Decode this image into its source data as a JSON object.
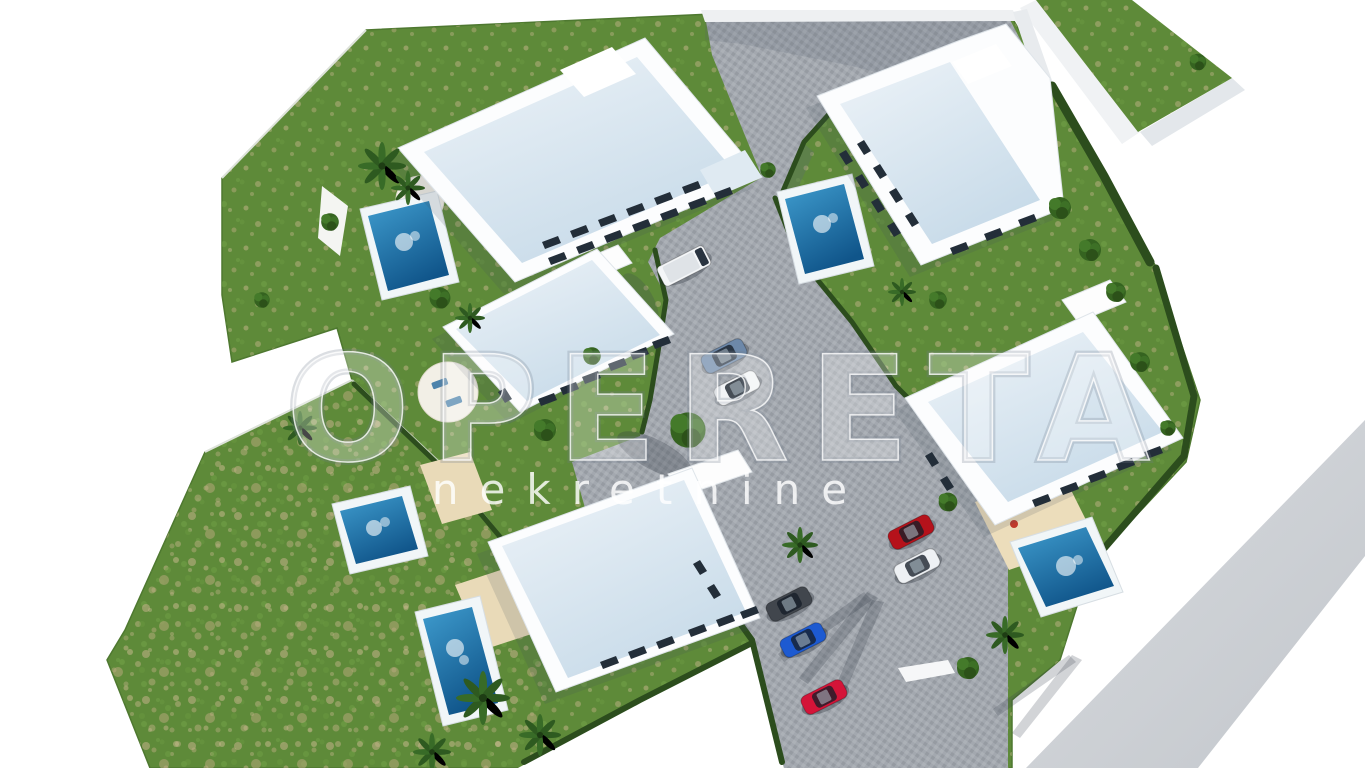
{
  "watermark": {
    "title": "OPERETA",
    "subtitle": "nekretnine"
  },
  "palette": {
    "background": "#ffffff",
    "grass": "#5e8a39",
    "hedge": "#2c4d1d",
    "pool_rim": "#f1f6f8",
    "pool_water": "#1e77ad",
    "pavement": "#a3a8af",
    "ribbon_road": "#cdd1d5",
    "building": "#fcfdfe",
    "roof": "#d8e5f0",
    "deck": "#e9dab8",
    "wall": "#eef0f2"
  },
  "vehicles": [
    {
      "name": "white-van",
      "color": "#f4f6f8"
    },
    {
      "name": "slate-blue-sedan",
      "color": "#6d88a9"
    },
    {
      "name": "white-sedan",
      "color": "#f2f4f6"
    },
    {
      "name": "red-coupe",
      "color": "#b5121b"
    },
    {
      "name": "white-hatchback",
      "color": "#eef1f4"
    },
    {
      "name": "graphite-car",
      "color": "#41464d"
    },
    {
      "name": "blue-hatchback",
      "color": "#1d5ad1"
    },
    {
      "name": "crimson-car",
      "color": "#d41438"
    }
  ],
  "site": {
    "buildings": 5,
    "pools": 5
  }
}
